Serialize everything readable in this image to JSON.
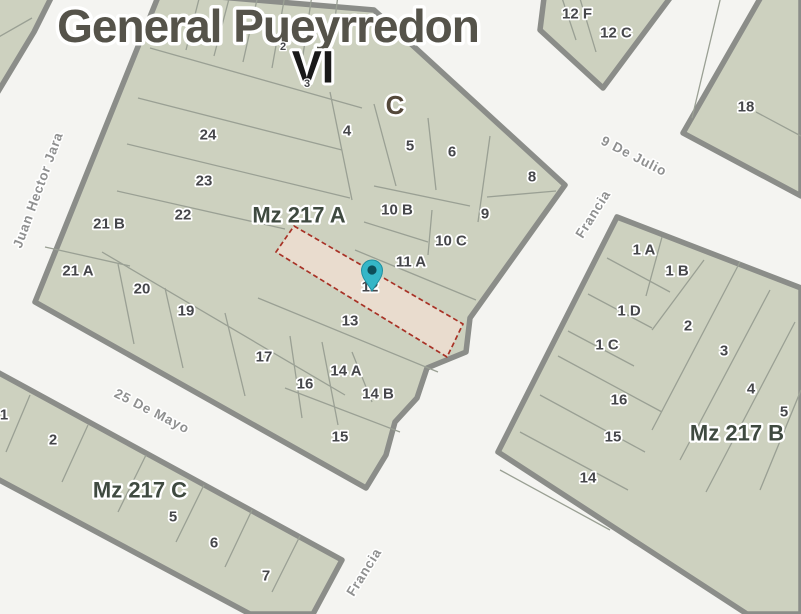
{
  "map": {
    "title": "General Pueyrredon",
    "zone_label": "VI",
    "section_label": "C",
    "block_labels": {
      "a": "Mz 217 A",
      "b": "Mz 217 B",
      "c": "Mz 217 C"
    },
    "selected_parcel": {
      "label": "12",
      "block": "Mz 217 A"
    },
    "street_labels": [
      {
        "name": "Juan Hector Jara",
        "x": 38,
        "y": 190,
        "rotate": -70
      },
      {
        "name": "25 De Mayo",
        "x": 152,
        "y": 411,
        "rotate": 27
      },
      {
        "name": "9 De Julio",
        "x": 634,
        "y": 156,
        "rotate": 27
      },
      {
        "name": "Francia",
        "x": 593,
        "y": 214,
        "rotate": -58
      },
      {
        "name": "Francia",
        "x": 364,
        "y": 572,
        "rotate": -58
      }
    ],
    "parcel_labels": [
      {
        "text": "24",
        "x": 208,
        "y": 135
      },
      {
        "text": "23",
        "x": 204,
        "y": 181
      },
      {
        "text": "22",
        "x": 183,
        "y": 215
      },
      {
        "text": "21 B",
        "x": 109,
        "y": 224
      },
      {
        "text": "21 A",
        "x": 78,
        "y": 271
      },
      {
        "text": "20",
        "x": 142,
        "y": 289
      },
      {
        "text": "19",
        "x": 186,
        "y": 311
      },
      {
        "text": "17",
        "x": 264,
        "y": 357
      },
      {
        "text": "16",
        "x": 305,
        "y": 384
      },
      {
        "text": "15",
        "x": 340,
        "y": 437
      },
      {
        "text": "14 A",
        "x": 346,
        "y": 371
      },
      {
        "text": "14 B",
        "x": 378,
        "y": 394
      },
      {
        "text": "13",
        "x": 350,
        "y": 321
      },
      {
        "text": "12",
        "x": 370,
        "y": 287
      },
      {
        "text": "11 A",
        "x": 411,
        "y": 262
      },
      {
        "text": "10 C",
        "x": 451,
        "y": 241
      },
      {
        "text": "10 B",
        "x": 397,
        "y": 210
      },
      {
        "text": "9",
        "x": 485,
        "y": 214
      },
      {
        "text": "8",
        "x": 532,
        "y": 177
      },
      {
        "text": "6",
        "x": 452,
        "y": 152
      },
      {
        "text": "5",
        "x": 410,
        "y": 146
      },
      {
        "text": "4",
        "x": 347,
        "y": 131
      },
      {
        "text": "2",
        "x": 283,
        "y": 47,
        "small": true
      },
      {
        "text": "3",
        "x": 307,
        "y": 84,
        "small": true
      },
      {
        "text": "12 F",
        "x": 577,
        "y": 14
      },
      {
        "text": "12 C",
        "x": 616,
        "y": 33
      },
      {
        "text": "18",
        "x": 746,
        "y": 107
      },
      {
        "text": "1 A",
        "x": 644,
        "y": 250
      },
      {
        "text": "1 B",
        "x": 677,
        "y": 271
      },
      {
        "text": "1 D",
        "x": 629,
        "y": 311
      },
      {
        "text": "1 C",
        "x": 607,
        "y": 345
      },
      {
        "text": "2",
        "x": 688,
        "y": 326
      },
      {
        "text": "3",
        "x": 724,
        "y": 351
      },
      {
        "text": "4",
        "x": 751,
        "y": 389
      },
      {
        "text": "5",
        "x": 784,
        "y": 412
      },
      {
        "text": "16",
        "x": 619,
        "y": 400
      },
      {
        "text": "15",
        "x": 613,
        "y": 437
      },
      {
        "text": "14",
        "x": 588,
        "y": 478
      },
      {
        "text": "1",
        "x": 4,
        "y": 415
      },
      {
        "text": "2",
        "x": 53,
        "y": 440
      },
      {
        "text": "5",
        "x": 173,
        "y": 517
      },
      {
        "text": "6",
        "x": 214,
        "y": 543
      },
      {
        "text": "7",
        "x": 266,
        "y": 576
      }
    ],
    "colors": {
      "street_background": "#f4f4f1",
      "parcel_fill": "#cdd1bf",
      "block_border": "#8b8d89",
      "parcel_line": "#9aa094",
      "selected_fill": "#ecdccf",
      "selected_border": "#a83226",
      "pin": "#35b6c7",
      "pin_center": "#0d4e59",
      "title_color": "#55534a",
      "zone_color": "#191919",
      "section_color": "#54483a",
      "block_label_color": "#3f4a40",
      "parcel_label_color": "#45464a",
      "street_label_color": "#8f9090"
    }
  }
}
